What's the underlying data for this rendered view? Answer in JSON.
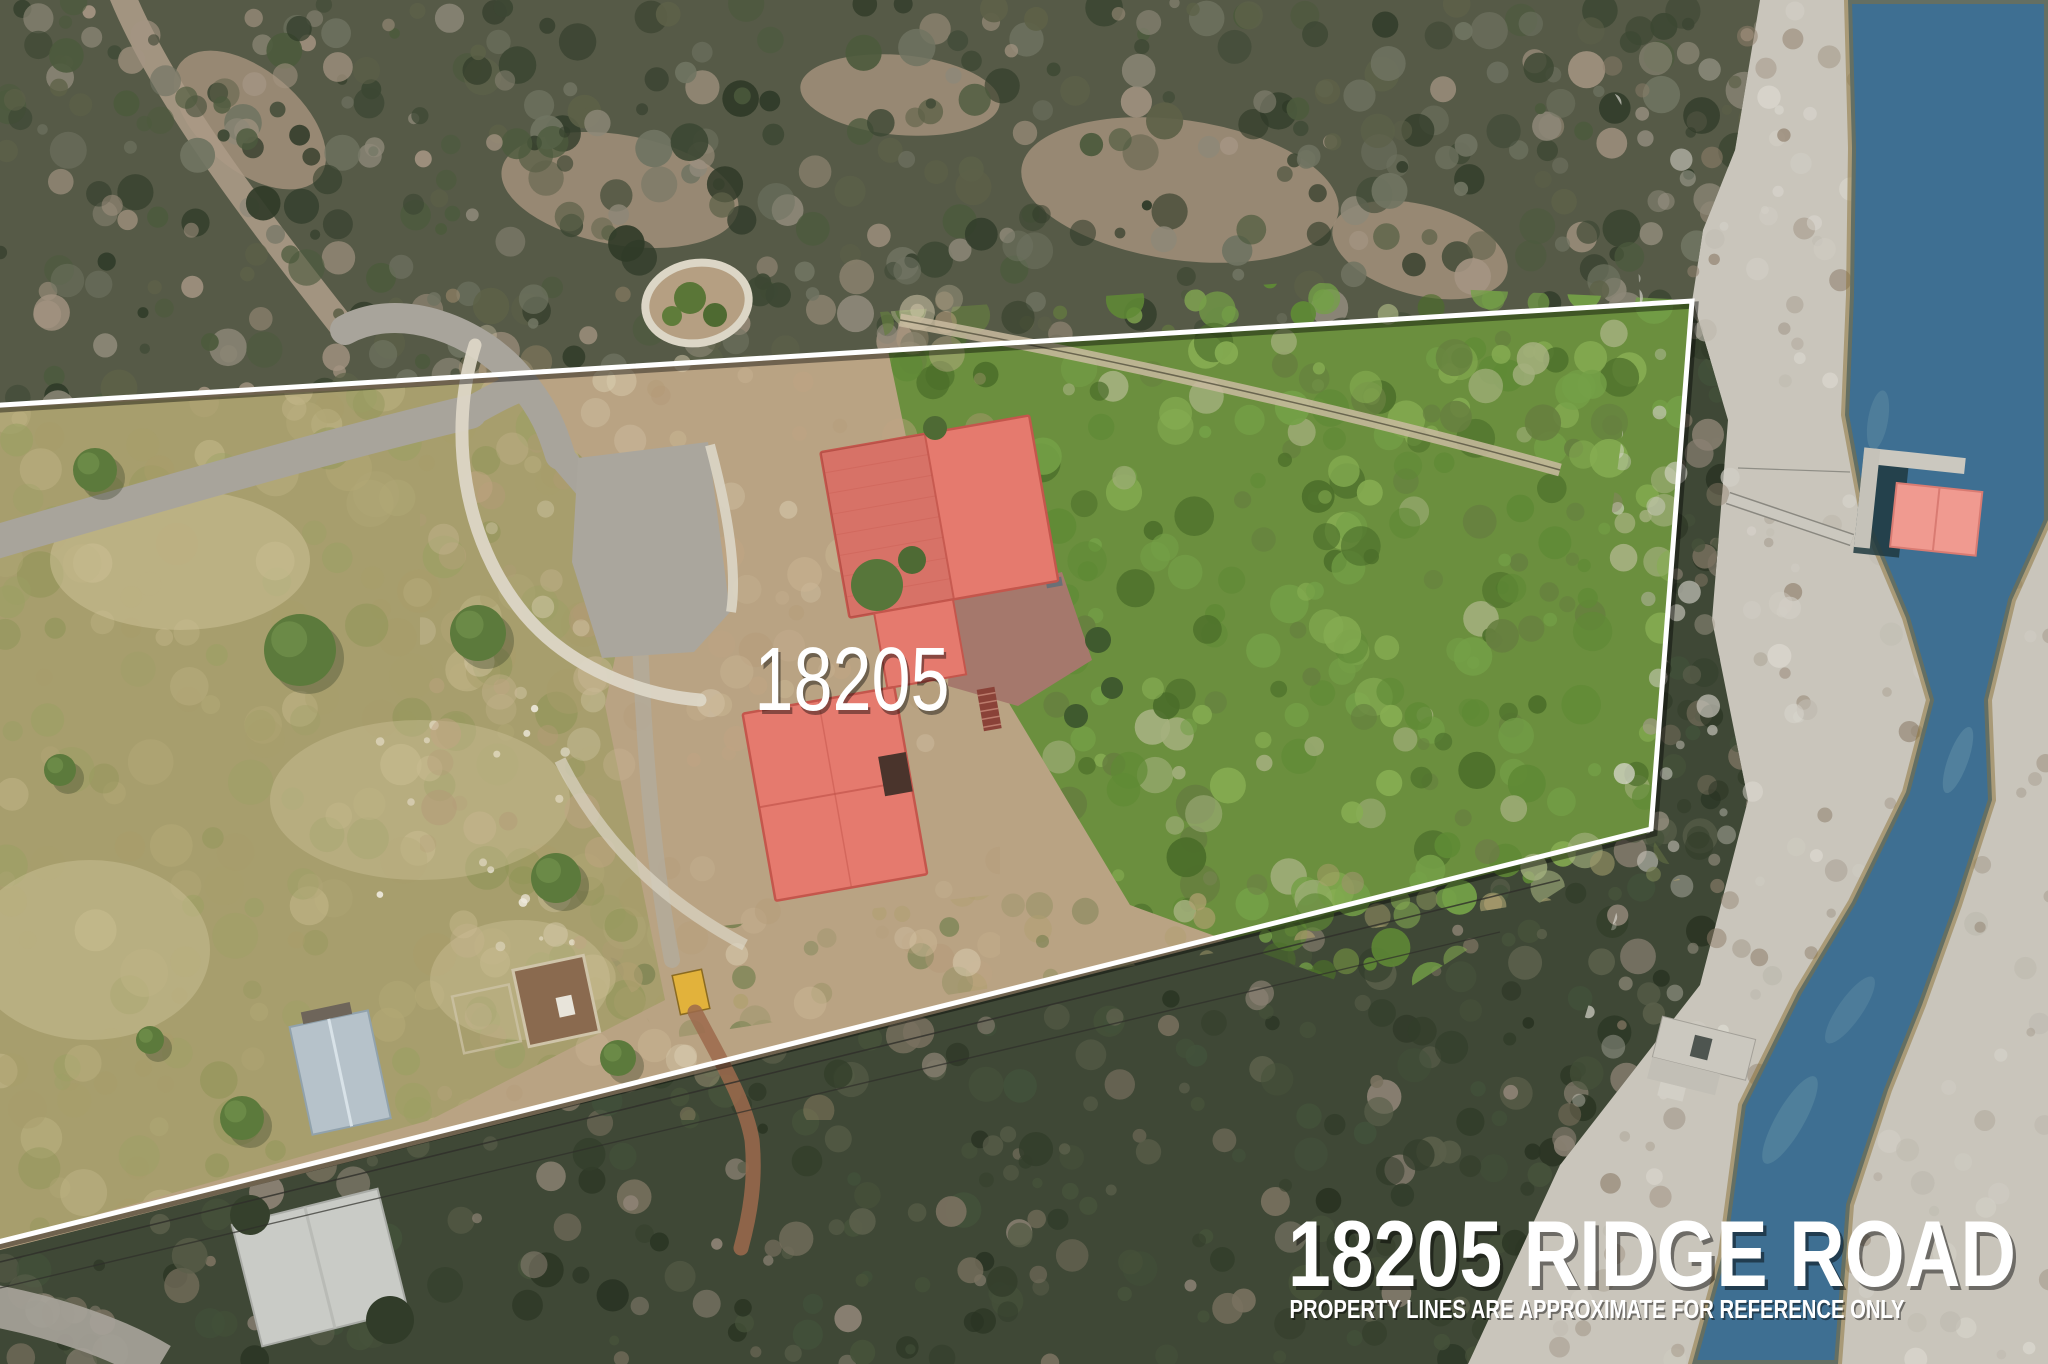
{
  "labels": {
    "property_number": "18205",
    "address_title": "18205 RIDGE ROAD",
    "disclaimer": "PROPERTY LINES ARE APPROXIMATE FOR REFERENCE ONLY"
  },
  "colors": {
    "dirt_base": "#b9a383",
    "pasture": "#a79e6d",
    "forest": "#6b8f3e",
    "woodland_top": "#565a47",
    "woodland_bottom": "#3f4836",
    "beach": "#c9c5bb",
    "water": "#3e6f92",
    "sediment_edge": "#8a6f33",
    "road": "#a8a49b",
    "parking": "#aaa69d",
    "stone_border": "#dcd6c6",
    "house_roof": "#e57a6e",
    "roof_ridge": "#c4564c",
    "deck": "#a5786c",
    "stairs": "#8a4238",
    "boathouse_roof": "#f09a90",
    "dock": "#cbc8bf",
    "shed_blue": "#b6c2ca",
    "shed_yellow": "#e2b23b",
    "shed_white": "#c9cbc6",
    "pen_dirt": "#8a6a4f",
    "boundary_line": "#ffffff",
    "label_text": "#ffffff"
  }
}
